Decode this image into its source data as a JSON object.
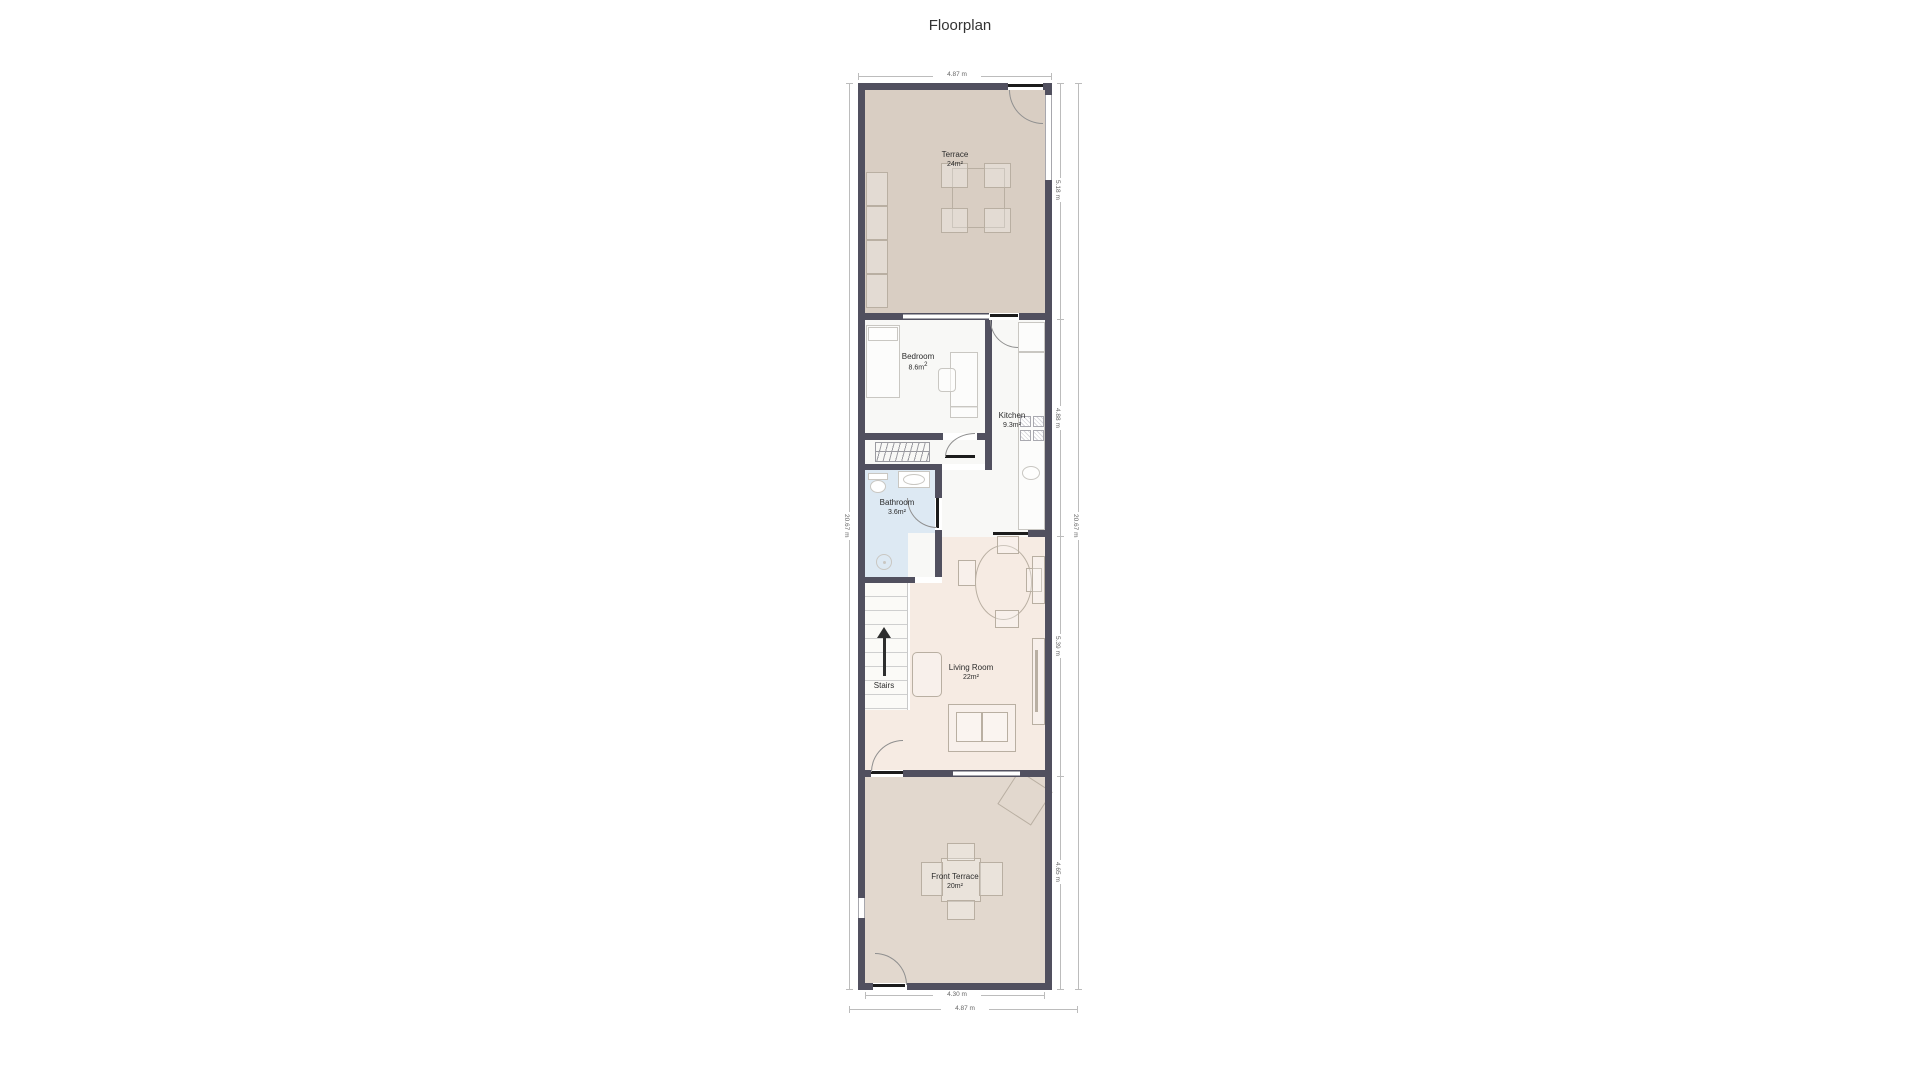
{
  "title": "Floorplan",
  "rooms": {
    "terrace": {
      "name": "Terrace",
      "area": "24m²"
    },
    "bedroom": {
      "name": "Bedroom",
      "area": "8.6m",
      "area_sup": "2"
    },
    "kitchen": {
      "name": "Kitchen",
      "area": "9.3m²"
    },
    "bathroom": {
      "name": "Bathroom",
      "area": "3.6m²"
    },
    "stairs": {
      "name": "Stairs"
    },
    "living_room": {
      "name": "Living Room",
      "area": "22m²"
    },
    "front_terrace": {
      "name": "Front Terrace",
      "area": "20m²"
    }
  },
  "dimensions": {
    "top_width": "4.87 m",
    "left_height": "20.67 m",
    "right_total_height": "20.67 m",
    "right_segments": [
      "5.18 m",
      "4.88 m",
      "5.39 m",
      "4.65 m"
    ],
    "bottom_inner_width": "4.30 m",
    "bottom_outer_width": "4.87 m"
  },
  "colors": {
    "wall": "#51505f",
    "terrace_floor": "#d9cec3",
    "front_terrace_floor": "#e2d8ce",
    "living_floor": "#f6ebe3",
    "bathroom_floor": "#dde9f3",
    "room_floor": "#f8f8f6"
  }
}
